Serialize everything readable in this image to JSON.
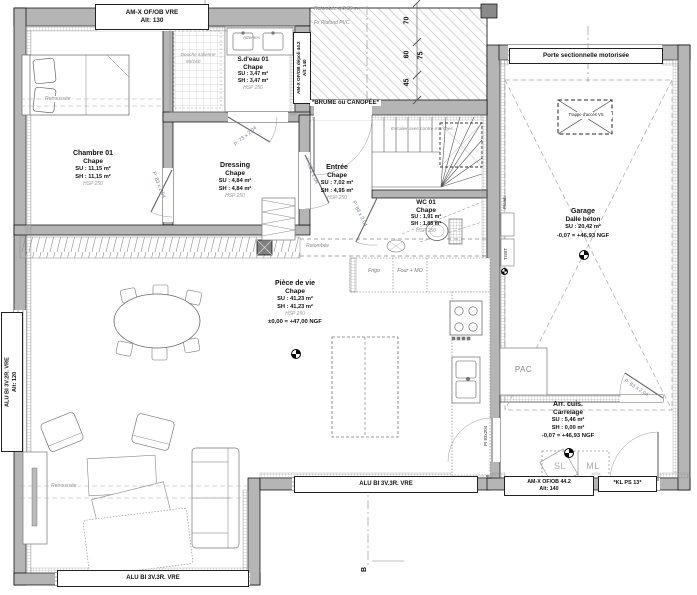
{
  "rooms": {
    "chambre": {
      "name": "Chambre 01",
      "floor": "Chape",
      "su": "SU : 11,15 m²",
      "sh": "SH : 11,15 m²",
      "hsp": "HSP 250"
    },
    "sdeau": {
      "name": "S.d'eau 01",
      "floor": "Chape",
      "su": "SU : 3,47 m²",
      "sh": "SH : 3,47 m²",
      "hsp": "HSP 250"
    },
    "dressing": {
      "name": "Dressing",
      "floor": "Chape",
      "su": "SU : 4,84 m²",
      "sh": "SH : 4,84 m²",
      "hsp": "HSP 250"
    },
    "entree": {
      "name": "Entrée",
      "floor": "Chape",
      "su": "SU : 7,02 m²",
      "sh": "SH : 4,95 m²",
      "hsp": "HSP 250"
    },
    "wc": {
      "name": "WC 01",
      "floor": "Chape",
      "su": "SU : 1,91 m²",
      "sh": "SH : 1,85 m²",
      "hsp": "HSP 250"
    },
    "piece": {
      "name": "Pièce de vie",
      "floor": "Chape",
      "su": "SU : 41,23 m²",
      "sh": "SH : 41,23 m²",
      "hsp": "HSP 250",
      "level": "±0,00 = +47,00 NGF"
    },
    "garage": {
      "name": "Garage",
      "floor": "Dalle béton",
      "su": "SU : 20,42 m²",
      "level": "-0,07 = +46,93 NGF"
    },
    "arrcuis": {
      "name": "Arr. cuis.",
      "floor": "Carrelage",
      "su": "SU : 5,46 m²",
      "sh": "SH : 0,00 m²",
      "level": "-0,07 = +46,93 NGF"
    }
  },
  "openings": {
    "win_top_l1": "AM-X OF/OB VRE",
    "win_top_l2": "Alt: 130",
    "win_sdeau_l1": "AM-X OF/OB dépoli 44.2",
    "win_sdeau_l2": "Alt: 140",
    "win_left_l1": "ALU BI 3V.2R. VRE",
    "win_left_l2": "Alt: 120",
    "win_bottom_left": "ALU BI 3V.3R. VRE",
    "win_bottom_mid": "ALU BI 3V.3R. VRE",
    "win_arr_l1": "AM-X OF/OB 44.2",
    "win_arr_l2": "Alt: 140",
    "door_kl": "*KL PS 13*",
    "garage_door": "Porte sectionnelle motorisée",
    "door_83": "P: 83 x 2,04",
    "door_73": "P: 73 x 2,04",
    "door_pi": "PI 83x204"
  },
  "notes": {
    "retombee_h": "Retombée à 2,35 m",
    "fx_plafond": "Fx Plafond PVC",
    "brume": "*BRUME ou CANOPÉE*",
    "escalier": "Escalier avec contre-marches",
    "douche_l1": "Douche italienne",
    "douche_l2": "90/160",
    "attentes": "Attentes",
    "retroussee": "Retroussée",
    "retombee": "Retombée",
    "plomb": "Plomb.",
    "tgbt": "TGBT",
    "trappe": "Trappe d'accès VS",
    "section_b": "B"
  },
  "appliances": {
    "frigo": "Frigo",
    "four": "Four + MO",
    "pac": "PAC",
    "sl": "SL",
    "ml": "ML"
  },
  "dimensions": {
    "seg_70": "70",
    "seg_60": "60",
    "seg_45": "45",
    "total_75": "75"
  }
}
